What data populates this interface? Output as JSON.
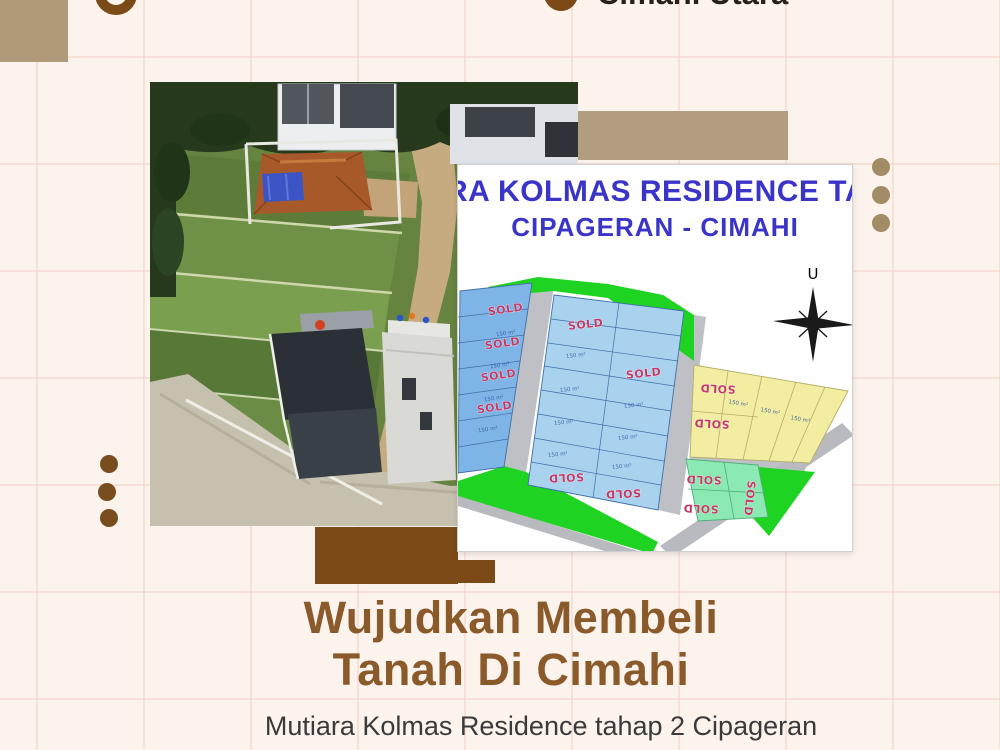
{
  "topbar": {
    "location_label": "Cimahi Utara"
  },
  "siteplan": {
    "title_line1": "RA KOLMAS RESIDENCE TA",
    "title_line2": "CIPAGERAN - CIMAHI",
    "compass_label": "U",
    "sold_label": "SOLD",
    "plot_area_label": "150 m²"
  },
  "headline": {
    "line1": "Wujudkan Membeli",
    "line2": "Tanah Di Cimahi"
  },
  "subtitle": {
    "text": "Mutiara Kolmas Residence tahap 2 Cipageran"
  },
  "colors": {
    "background": "#fcf3ed",
    "grid_line": "rgba(240,210,200,0.55)",
    "tan_square": "#b19a79",
    "tan_rect": "#b29d80",
    "brown": "#7c4a16",
    "dot_left": "#7a4d1f",
    "dot_right": "#a28c66",
    "headline": "#8a5a2b",
    "subtitle": "#3a3a3a",
    "top_text": "#262018",
    "plan_title": "#3a35c8",
    "sold": "#c23a66",
    "plot_blue": "#7fb5e6",
    "plot_blue_light": "#a9d2ef",
    "plot_yellow": "#f2eda0",
    "plot_mint": "#8ce9b4",
    "plot_green": "#1ed321",
    "road_gray": "#bfc0c5"
  }
}
